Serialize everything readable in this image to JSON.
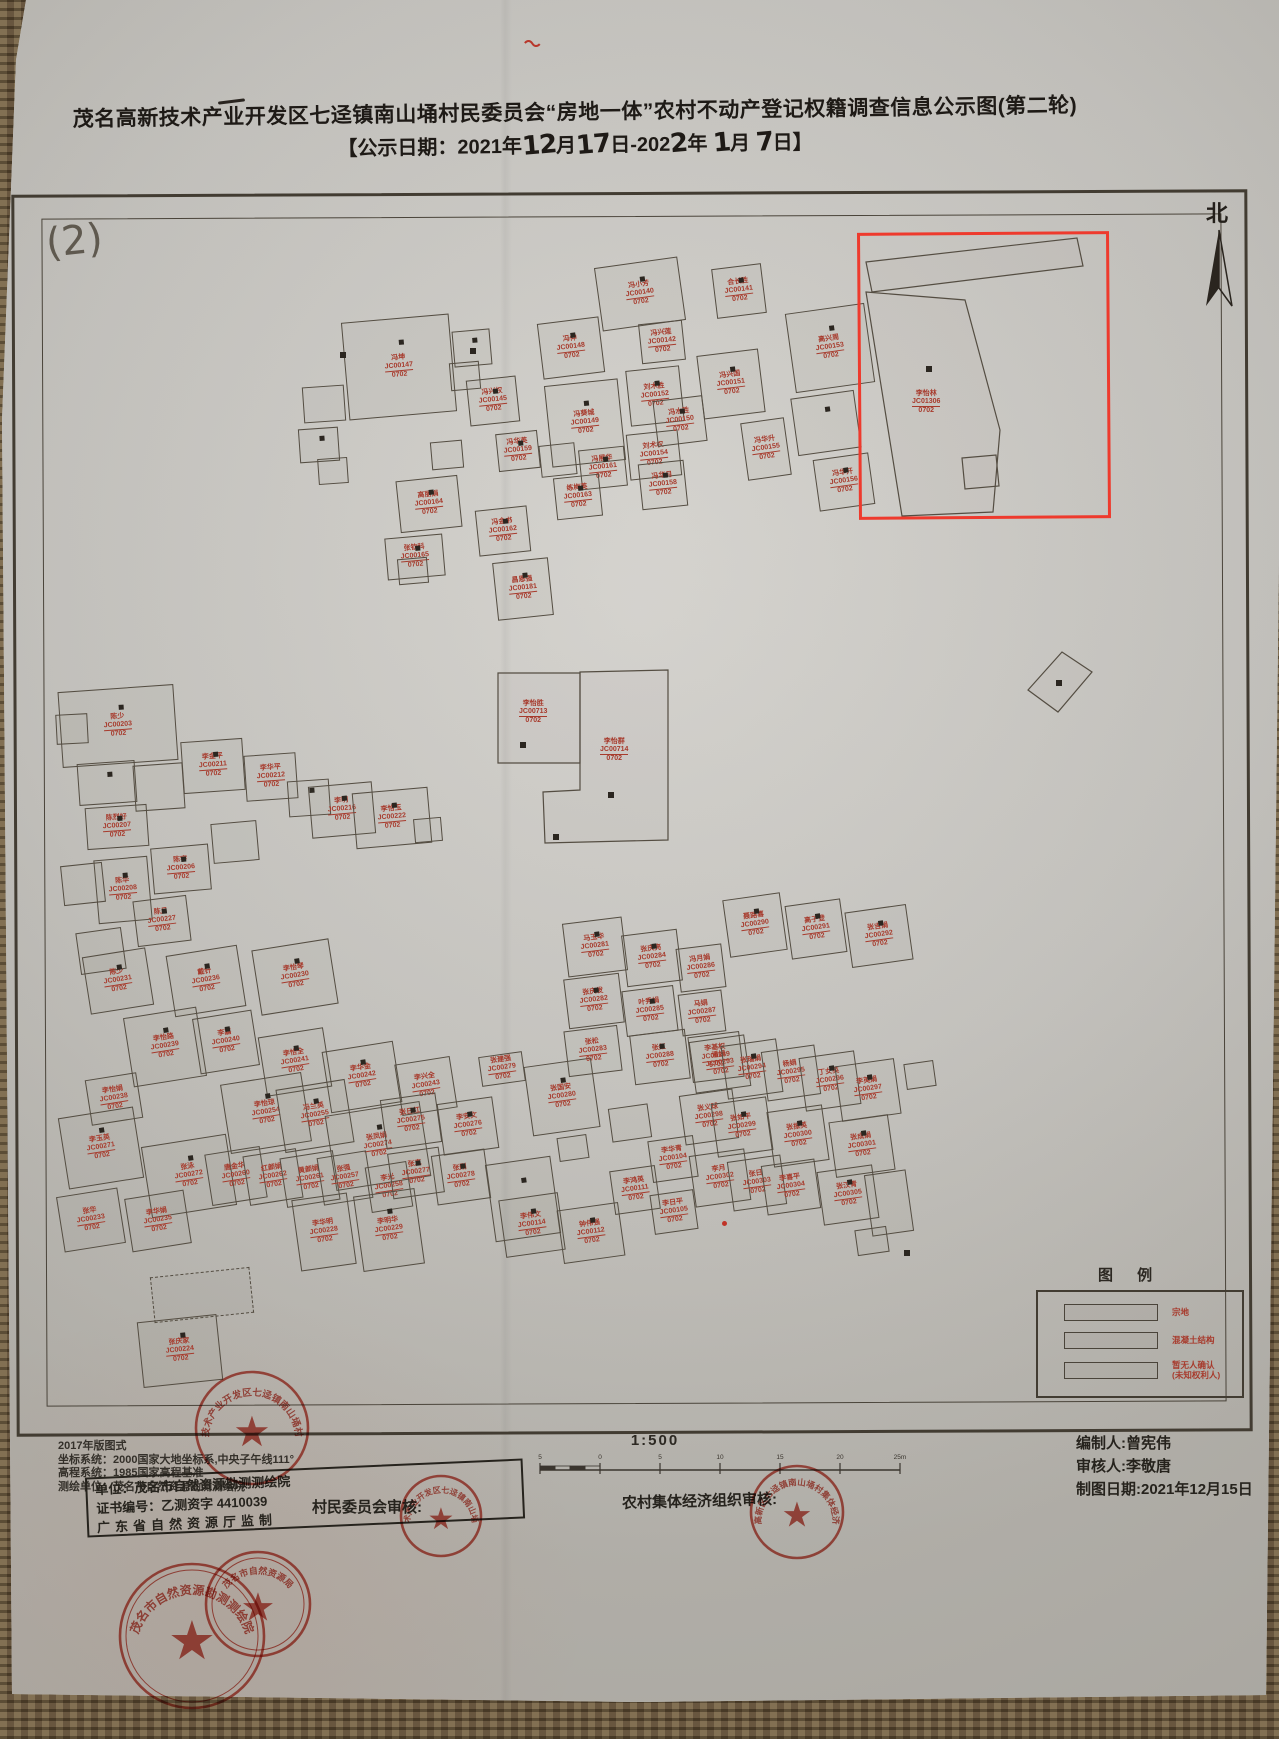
{
  "photo": {
    "colors": {
      "paper": "#cac8c3",
      "mat_brown": "#6b5741",
      "ink": "#2c2822",
      "building_outline": "#544d42",
      "label_red": "#a73a2c",
      "stamp_red": "#c23b2e",
      "highlight_red": "#ee3a2d"
    }
  },
  "title": {
    "line1": "茂名高新技术产业开发区七迳镇南山埇村民委员会“房地一体”农村不动产登记权籍调查信息公示图(第二轮)"
  },
  "notice_date": {
    "segments": [
      {
        "t": "print",
        "v": "【公示日期：2021年"
      },
      {
        "t": "hand",
        "v": "12"
      },
      {
        "t": "print",
        "v": "月"
      },
      {
        "t": "hand",
        "v": "17"
      },
      {
        "t": "print",
        "v": "日-202"
      },
      {
        "t": "hand",
        "v": "2"
      },
      {
        "t": "print",
        "v": "年 "
      },
      {
        "t": "hand",
        "v": "1"
      },
      {
        "t": "print",
        "v": "月 "
      },
      {
        "t": "hand",
        "v": "7"
      },
      {
        "t": "print",
        "v": "日】"
      }
    ]
  },
  "map": {
    "sheet_number": "(2)",
    "north_label": "北",
    "sub_label": "0702",
    "highlight_owner": {
      "name": "李怡林",
      "code": "JC01306",
      "sub": "0702"
    },
    "parcels": [
      {
        "points": "866,262 1077,238 1083,266 872,292",
        "label": null
      },
      {
        "points": "866,292 965,300 1000,430 993,512 902,516",
        "label": {
          "name": "李怡林",
          "code": "JC01306",
          "x": 912,
          "y": 390
        }
      },
      {
        "points": "962,458 996,455 999,486 965,489",
        "label": null
      },
      {
        "points": "1028,690 1062,652 1092,672 1058,712",
        "label": null
      },
      {
        "points": "498,673 580,673 580,763 498,763",
        "label": {
          "name": "李怡胜",
          "code": "JC00713",
          "x": 519,
          "y": 700
        }
      },
      {
        "points": "580,672 668,670 668,840 545,843 543,792 580,790",
        "label": {
          "name": "李怡群",
          "code": "JC00714",
          "x": 600,
          "y": 738
        }
      }
    ],
    "marks": [
      [
        926,
        366
      ],
      [
        520,
        742
      ],
      [
        608,
        792
      ],
      [
        553,
        834
      ],
      [
        1056,
        680
      ],
      [
        904,
        1250
      ],
      [
        470,
        348
      ],
      [
        340,
        352
      ]
    ],
    "buildings": [
      [
        598,
        262,
        84,
        64,
        -8,
        "冯小芳",
        "JC00140",
        1
      ],
      [
        714,
        266,
        50,
        50,
        -7,
        "合长胜",
        "JC00141",
        1
      ],
      [
        640,
        322,
        44,
        40,
        -6,
        "冯兴莲",
        "JC00142",
        0
      ],
      [
        345,
        318,
        108,
        98,
        -5,
        "冯坤",
        "JC00147",
        1
      ],
      [
        303,
        386,
        42,
        36,
        -4,
        "",
        "",
        0
      ],
      [
        299,
        428,
        40,
        34,
        -4,
        "",
        "",
        1
      ],
      [
        318,
        458,
        30,
        26,
        -4,
        "",
        "",
        0
      ],
      [
        453,
        330,
        38,
        36,
        -5,
        "",
        "",
        1
      ],
      [
        450,
        362,
        30,
        28,
        -5,
        "",
        "",
        0
      ],
      [
        468,
        378,
        50,
        46,
        -6,
        "冯兴权",
        "JC00145",
        1
      ],
      [
        540,
        320,
        62,
        56,
        -7,
        "冯伸",
        "JC00148",
        1
      ],
      [
        548,
        382,
        74,
        82,
        -6,
        "冯葵城",
        "JC00149",
        1
      ],
      [
        628,
        368,
        54,
        56,
        -6,
        "刘术胜",
        "JC00152",
        1
      ],
      [
        700,
        352,
        62,
        64,
        -7,
        "冯兴国",
        "JC00151",
        1
      ],
      [
        790,
        308,
        80,
        80,
        -8,
        "高兴周",
        "JC00153",
        1
      ],
      [
        794,
        394,
        64,
        58,
        -8,
        "",
        "",
        1
      ],
      [
        816,
        456,
        56,
        52,
        -8,
        "冯华开",
        "JC00156",
        1
      ],
      [
        628,
        432,
        52,
        46,
        -6,
        "刘术权",
        "JC00154",
        0
      ],
      [
        580,
        448,
        46,
        40,
        -6,
        "冯展华",
        "JC00161",
        1
      ],
      [
        540,
        444,
        36,
        32,
        -6,
        "",
        "",
        0
      ],
      [
        497,
        432,
        42,
        38,
        -6,
        "冯华英",
        "JC00159",
        1
      ],
      [
        431,
        441,
        32,
        28,
        -5,
        "",
        "",
        0
      ],
      [
        555,
        476,
        46,
        42,
        -6,
        "练梅英",
        "JC00163",
        1
      ],
      [
        640,
        462,
        46,
        46,
        -6,
        "冯华月",
        "JC00158",
        1
      ],
      [
        655,
        398,
        50,
        46,
        -7,
        "冯水胜",
        "JC00150",
        1
      ],
      [
        744,
        420,
        44,
        58,
        -8,
        "冯华升",
        "JC00155",
        0
      ],
      [
        398,
        478,
        62,
        52,
        -6,
        "高丽娟",
        "JC00164",
        1
      ],
      [
        477,
        508,
        52,
        46,
        -6,
        "冯金书",
        "JC00162",
        1
      ],
      [
        386,
        536,
        58,
        42,
        -5,
        "张钦科",
        "JC00165",
        1
      ],
      [
        495,
        560,
        56,
        58,
        -6,
        "昌恩强",
        "JC00181",
        1
      ],
      [
        398,
        558,
        30,
        26,
        -5,
        "",
        "",
        0
      ],
      [
        60,
        688,
        116,
        76,
        -4,
        "陈少",
        "JC00203",
        1
      ],
      [
        56,
        714,
        32,
        30,
        -3,
        "",
        "",
        0
      ],
      [
        78,
        762,
        58,
        42,
        -4,
        "",
        "",
        1
      ],
      [
        134,
        764,
        50,
        46,
        -4,
        "",
        "",
        0
      ],
      [
        86,
        806,
        62,
        42,
        -4,
        "陈烈好",
        "JC00207",
        1
      ],
      [
        182,
        740,
        62,
        52,
        -4,
        "李金平",
        "JC00211",
        1
      ],
      [
        245,
        754,
        52,
        46,
        -4,
        "李华平",
        "JC00212",
        0
      ],
      [
        288,
        780,
        42,
        36,
        -4,
        "",
        "",
        1
      ],
      [
        310,
        784,
        64,
        52,
        -5,
        "李明",
        "JC00216",
        1
      ],
      [
        354,
        790,
        76,
        56,
        -5,
        "李怡玉",
        "JC00222",
        1
      ],
      [
        414,
        818,
        28,
        24,
        -5,
        "",
        "",
        0
      ],
      [
        152,
        846,
        58,
        46,
        -5,
        "陈宇",
        "JC00206",
        1
      ],
      [
        212,
        822,
        46,
        40,
        -5,
        "",
        "",
        0
      ],
      [
        96,
        858,
        54,
        64,
        -5,
        "陈华",
        "JC00208",
        1
      ],
      [
        62,
        864,
        42,
        40,
        -6,
        "",
        "",
        0
      ],
      [
        135,
        898,
        54,
        46,
        -7,
        "陈月",
        "JC00227",
        1
      ],
      [
        78,
        930,
        46,
        42,
        -8,
        "",
        "",
        0
      ],
      [
        86,
        952,
        64,
        58,
        -9,
        "陈少",
        "JC00231",
        1
      ],
      [
        170,
        950,
        72,
        62,
        -9,
        "戴针",
        "JC00236",
        1
      ],
      [
        256,
        944,
        78,
        66,
        -9,
        "李怡琴",
        "JC00230",
        1
      ],
      [
        128,
        1012,
        74,
        70,
        -9,
        "李怡路",
        "JC00239",
        1
      ],
      [
        196,
        1014,
        60,
        56,
        -9,
        "李嘉",
        "JC00240",
        1
      ],
      [
        262,
        1032,
        66,
        60,
        -9,
        "李怡全",
        "JC00241",
        1
      ],
      [
        326,
        1046,
        72,
        62,
        -9,
        "李华金",
        "JC00242",
        1
      ],
      [
        398,
        1060,
        56,
        52,
        -9,
        "李兴全",
        "JC00243",
        0
      ],
      [
        88,
        1076,
        52,
        46,
        -9,
        "李怡娟",
        "JC00238",
        0
      ],
      [
        225,
        1078,
        82,
        70,
        -9,
        "李怡琼",
        "JC00254",
        1
      ],
      [
        280,
        1084,
        70,
        64,
        -9,
        "冯兰英",
        "JC00255",
        1
      ],
      [
        330,
        1108,
        96,
        76,
        -9,
        "张凤娟",
        "JC00274",
        1
      ],
      [
        63,
        1112,
        76,
        72,
        -9,
        "李玉英",
        "JC00271",
        1
      ],
      [
        146,
        1140,
        86,
        72,
        -9,
        "张泳",
        "JC00272",
        1
      ],
      [
        208,
        1150,
        56,
        52,
        -9,
        "唐金华",
        "JC00260",
        0
      ],
      [
        246,
        1152,
        54,
        50,
        -9,
        "红颜娟",
        "JC00262",
        0
      ],
      [
        283,
        1154,
        54,
        50,
        -9,
        "黄颜娟",
        "JC00261",
        0
      ],
      [
        320,
        1154,
        50,
        48,
        -9,
        "张强",
        "JC00257",
        0
      ],
      [
        368,
        1164,
        42,
        46,
        -9,
        "李光",
        "JC00258",
        0
      ],
      [
        60,
        1192,
        62,
        56,
        -9,
        "张华",
        "JC00233",
        0
      ],
      [
        128,
        1194,
        60,
        54,
        -9,
        "李华娟",
        "JC00235",
        0
      ],
      [
        152,
        1272,
        100,
        46,
        -6,
        "",
        "",
        2
      ],
      [
        140,
        1318,
        80,
        66,
        -6,
        "张庆家",
        "JC00224",
        1
      ],
      [
        296,
        1196,
        56,
        72,
        -8,
        "李华明",
        "JC00228",
        0
      ],
      [
        358,
        1192,
        62,
        76,
        -8,
        "李明华",
        "JC00229",
        1
      ],
      [
        383,
        1096,
        56,
        50,
        -8,
        "张日红",
        "JC00275",
        1
      ],
      [
        440,
        1100,
        56,
        52,
        -8,
        "李安文",
        "JC00276",
        1
      ],
      [
        390,
        1150,
        52,
        46,
        -8,
        "张真",
        "JC00277",
        1
      ],
      [
        434,
        1152,
        54,
        50,
        -8,
        "张刚",
        "JC00278",
        1
      ],
      [
        480,
        1054,
        44,
        30,
        -8,
        "张建强",
        "JC00279",
        0
      ],
      [
        528,
        1062,
        68,
        70,
        -8,
        "张国安",
        "JC00280",
        1
      ],
      [
        490,
        1160,
        66,
        78,
        -8,
        "",
        "",
        1
      ],
      [
        558,
        1136,
        30,
        24,
        -8,
        "",
        "",
        0
      ],
      [
        502,
        1196,
        60,
        58,
        -8,
        "李伟文",
        "JC00114",
        1
      ],
      [
        560,
        1206,
        62,
        54,
        -8,
        "钟伟强",
        "JC00112",
        1
      ],
      [
        612,
        1168,
        46,
        44,
        -8,
        "李鸿英",
        "JC00111",
        0
      ],
      [
        650,
        1138,
        46,
        42,
        -8,
        "李华青",
        "JC00104",
        0
      ],
      [
        652,
        1192,
        44,
        40,
        -8,
        "李日平",
        "JC00105",
        0
      ],
      [
        610,
        1106,
        40,
        34,
        -8,
        "",
        "",
        0
      ],
      [
        565,
        920,
        60,
        54,
        -7,
        "马玉华",
        "JC00281",
        1
      ],
      [
        566,
        976,
        56,
        50,
        -7,
        "张庆发",
        "JC00282",
        1
      ],
      [
        566,
        1028,
        54,
        46,
        -7,
        "张松",
        "JC00283",
        0
      ],
      [
        624,
        932,
        56,
        52,
        -7,
        "张庆亮",
        "JC00284",
        1
      ],
      [
        624,
        988,
        52,
        46,
        -7,
        "叶秀娟",
        "JC00285",
        1
      ],
      [
        678,
        946,
        46,
        44,
        -7,
        "冯月娟",
        "JC00286",
        0
      ],
      [
        680,
        992,
        44,
        42,
        -7,
        "马娟",
        "JC00287",
        0
      ],
      [
        632,
        1032,
        56,
        50,
        -7,
        "张红",
        "JC00288",
        1
      ],
      [
        690,
        1034,
        52,
        46,
        -7,
        "李基权",
        "JC00289",
        0
      ],
      [
        726,
        896,
        58,
        58,
        -8,
        "聂路喜",
        "JC00290",
        1
      ],
      [
        788,
        902,
        56,
        54,
        -8,
        "高子登",
        "JC00291",
        1
      ],
      [
        848,
        908,
        62,
        56,
        -8,
        "张吉娟",
        "JC00292",
        1
      ],
      [
        692,
        1038,
        56,
        52,
        -8,
        "潘娟",
        "JC00293",
        0
      ],
      [
        724,
        1042,
        56,
        54,
        -8,
        "张瑞娟",
        "JC00294",
        1
      ],
      [
        764,
        1048,
        54,
        50,
        -8,
        "杨娟",
        "JC00295",
        0
      ],
      [
        802,
        1054,
        56,
        54,
        -8,
        "丁女英",
        "JC00296",
        1
      ],
      [
        838,
        1062,
        60,
        56,
        -8,
        "李英娟",
        "JC00297",
        1
      ],
      [
        682,
        1092,
        54,
        50,
        -8,
        "张义球",
        "JC00298",
        0
      ],
      [
        714,
        1100,
        56,
        54,
        -8,
        "张如平",
        "JC00299",
        1
      ],
      [
        770,
        1108,
        56,
        56,
        -8,
        "张振英",
        "JC00300",
        1
      ],
      [
        832,
        1118,
        60,
        56,
        -8,
        "张成娟",
        "JC00301",
        1
      ],
      [
        692,
        1152,
        56,
        52,
        -8,
        "李月",
        "JC00302",
        0
      ],
      [
        730,
        1158,
        54,
        50,
        -8,
        "张日",
        "JC00303",
        0
      ],
      [
        764,
        1162,
        54,
        50,
        -8,
        "李喜平",
        "JC00304",
        0
      ],
      [
        820,
        1168,
        56,
        54,
        -8,
        "张汉青",
        "JC00305",
        1
      ],
      [
        868,
        1172,
        42,
        62,
        -8,
        "",
        "",
        0
      ],
      [
        905,
        1062,
        30,
        26,
        -8,
        "",
        "",
        0
      ],
      [
        856,
        1228,
        32,
        26,
        -8,
        "",
        "",
        0
      ]
    ]
  },
  "legend": {
    "title": "图 例",
    "items": [
      {
        "label": "宗地"
      },
      {
        "label": "混凝土结构"
      },
      {
        "label": "暂无人确认\n(未知权利人)"
      }
    ]
  },
  "scale": {
    "text": "1:500",
    "tick_labels": [
      "5",
      "0",
      "5",
      "10",
      "15",
      "20",
      "25m"
    ]
  },
  "footer": {
    "left_lines": [
      "2017年版图式",
      "坐标系统：2000国家大地坐标系,中央子午线111°",
      "高程系统：1985国家高程基准",
      "测绘单位：茂名市自然资源勘测测绘院"
    ],
    "cert_stamp_lines": [
      "单位：茂名市自然资源勘测测绘院",
      "证书编号：乙测资字 4410039",
      "广东省自然资源厅监制"
    ],
    "review_left": "村民委员会审核:",
    "review_right": "农村集体经济组织审核:",
    "credits": [
      "编制人:曾宪伟",
      "审核人:李敬唐",
      "制图日期:2021年12月15日"
    ]
  },
  "stamps": [
    {
      "cx": 252,
      "cy": 1428,
      "r": 56,
      "fs": 9.5,
      "inner": 0,
      "text": "茂名高新技术产业开发区七迳镇南山埇村民委员会"
    },
    {
      "cx": 441,
      "cy": 1516,
      "r": 40,
      "fs": 8,
      "inner": 0,
      "text": "茂名高新技术产业开发区七迳镇南山埇村民委员会"
    },
    {
      "cx": 797,
      "cy": 1512,
      "r": 46,
      "fs": 8.5,
      "inner": 0,
      "text": "茂名高新区七迳镇南山埇村集体经济组织"
    },
    {
      "cx": 192,
      "cy": 1636,
      "r": 72,
      "fs": 12,
      "inner": 1,
      "text": "茂名市自然资源勘测测绘院"
    },
    {
      "cx": 258,
      "cy": 1604,
      "r": 52,
      "fs": 9,
      "inner": 1,
      "text": "茂名市自然资源局"
    }
  ]
}
